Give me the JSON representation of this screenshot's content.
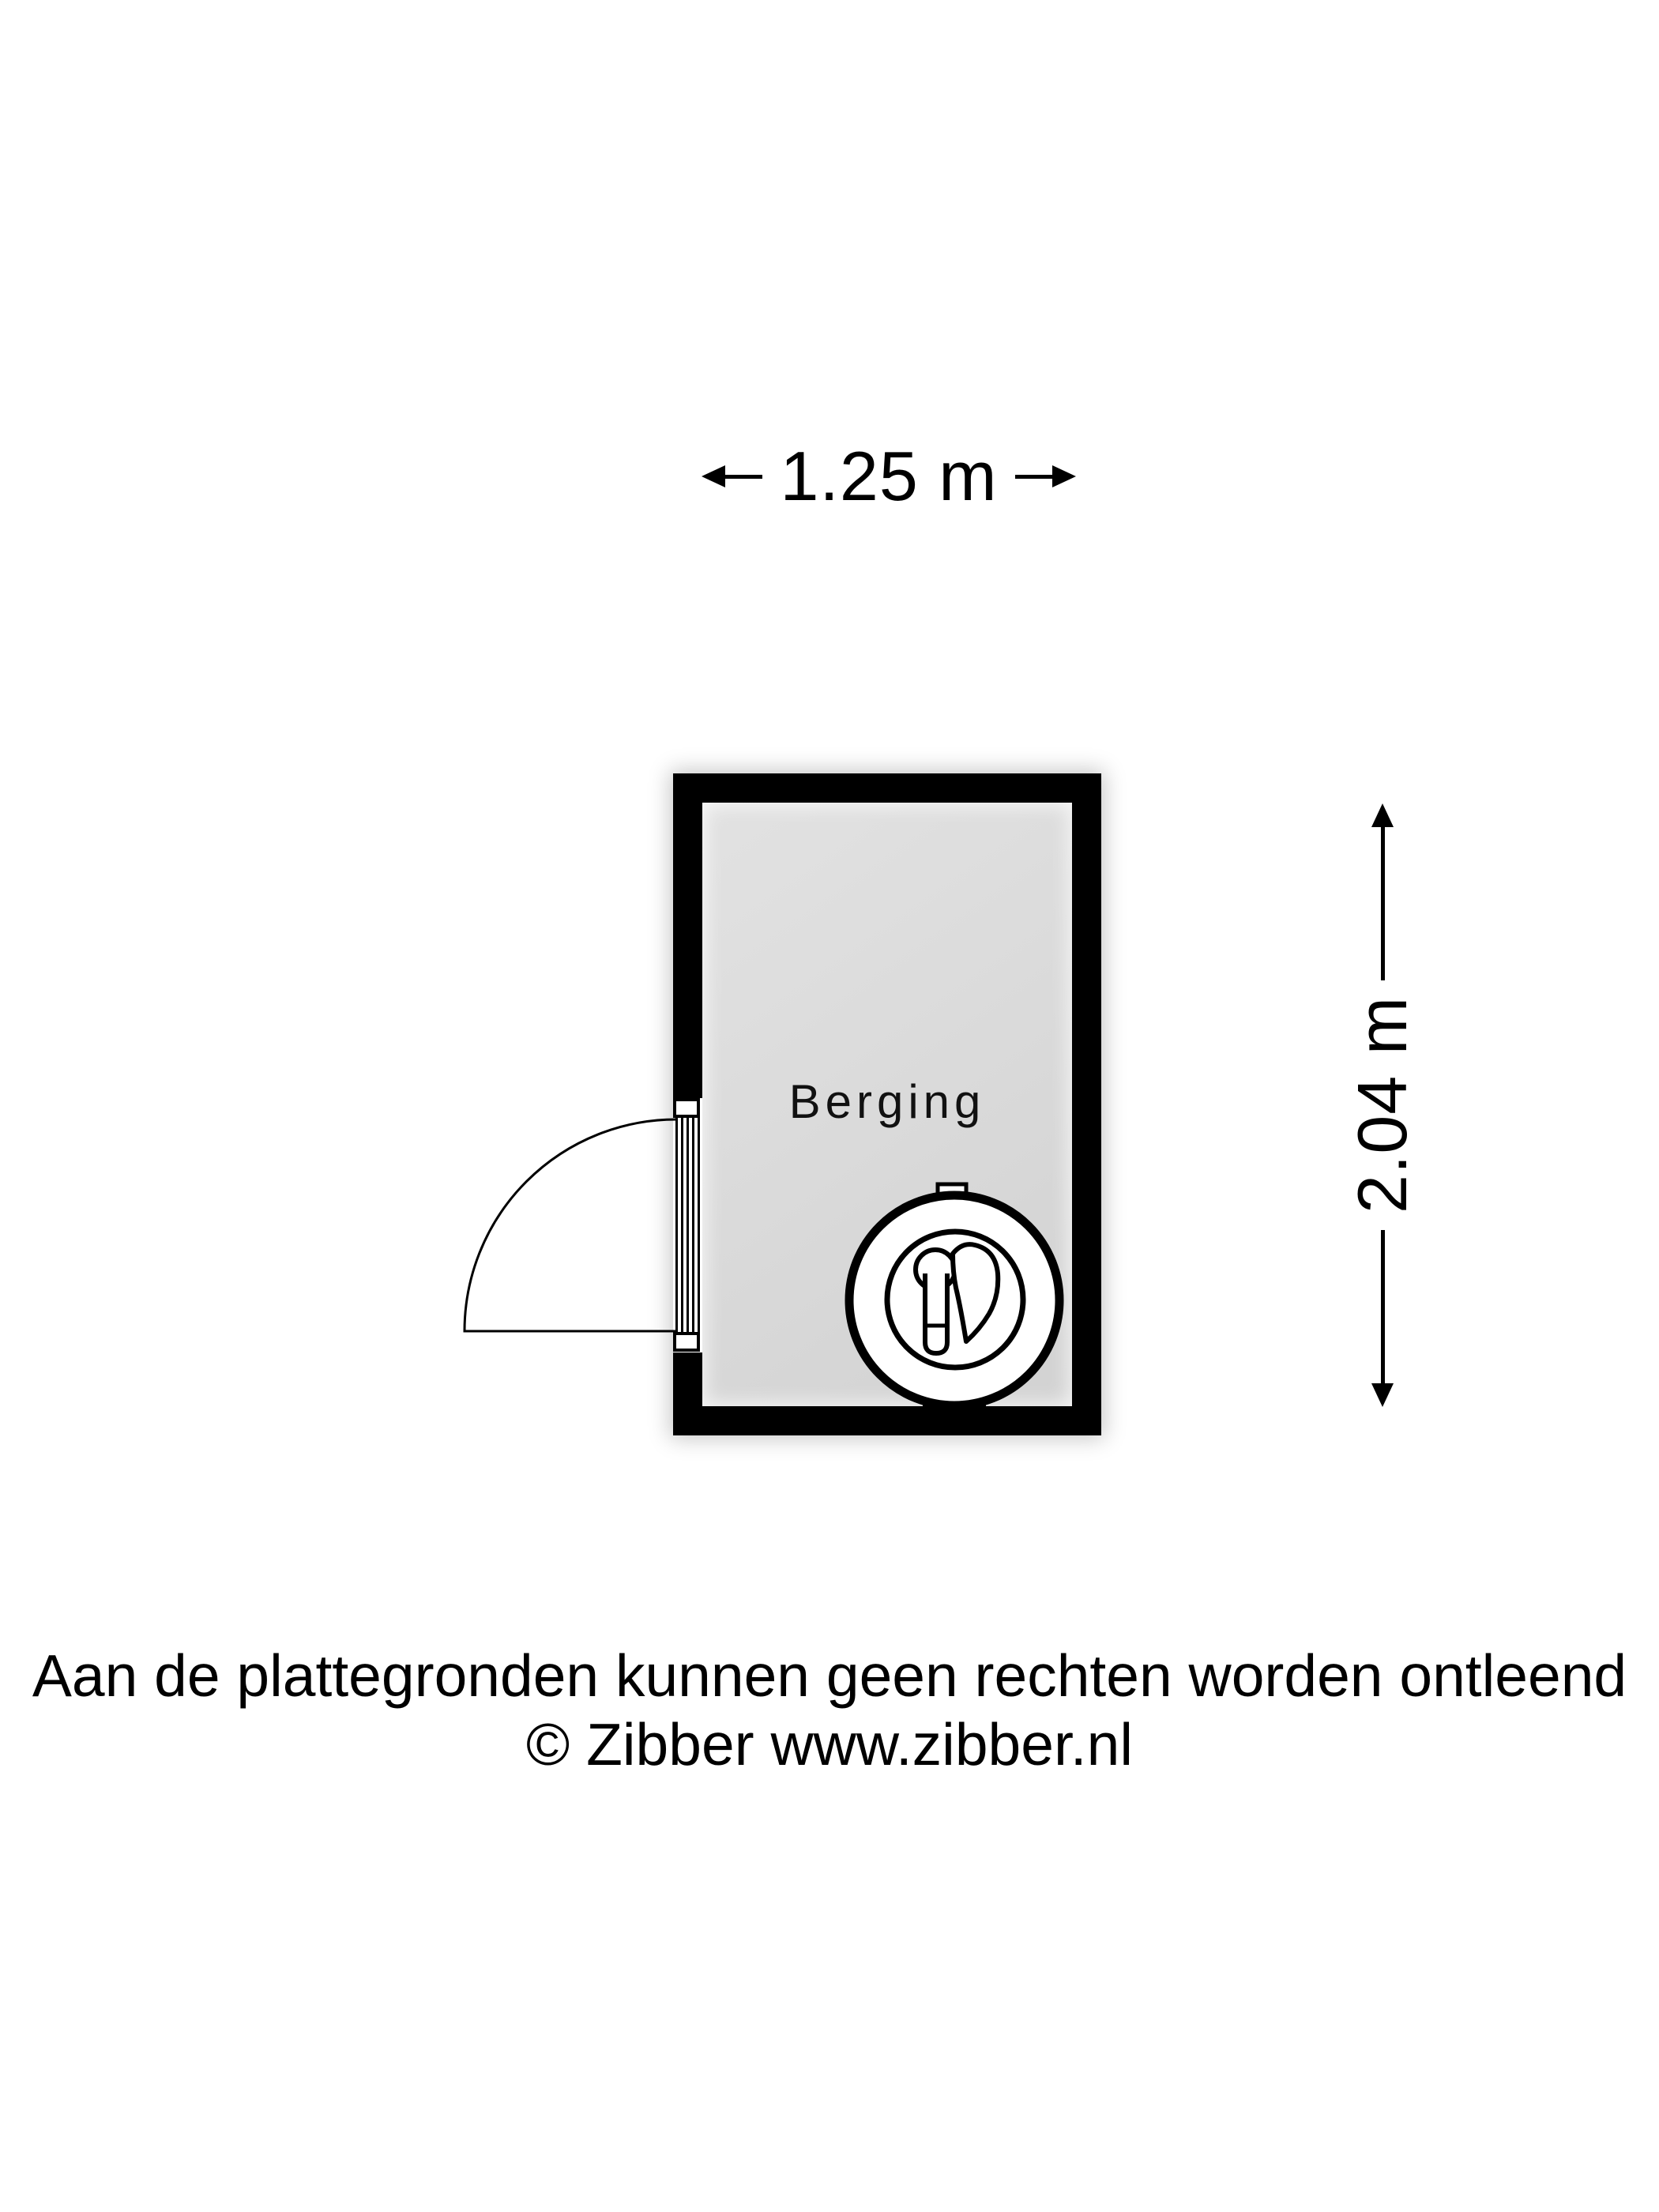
{
  "dimensions": {
    "width_label": "1.25 m",
    "height_label": "2.04 m"
  },
  "room": {
    "label": "Berging"
  },
  "footer": {
    "line1": "Aan de plattegronden kunnen geen rechten worden ontleend",
    "line2": "© Zibber www.zibber.nl"
  },
  "colors": {
    "wall": "#000000",
    "floor": "#dbdbdb",
    "background": "#ffffff",
    "text": "#000000"
  },
  "icons": {
    "door": "door-swing-icon (quarter-circle arc with leaf line)",
    "washing_machine": "washing-machine-icon (double circle with keyhole and water-drop)",
    "dimension_arrows": "solid-triangle-arrowhead-icons"
  }
}
